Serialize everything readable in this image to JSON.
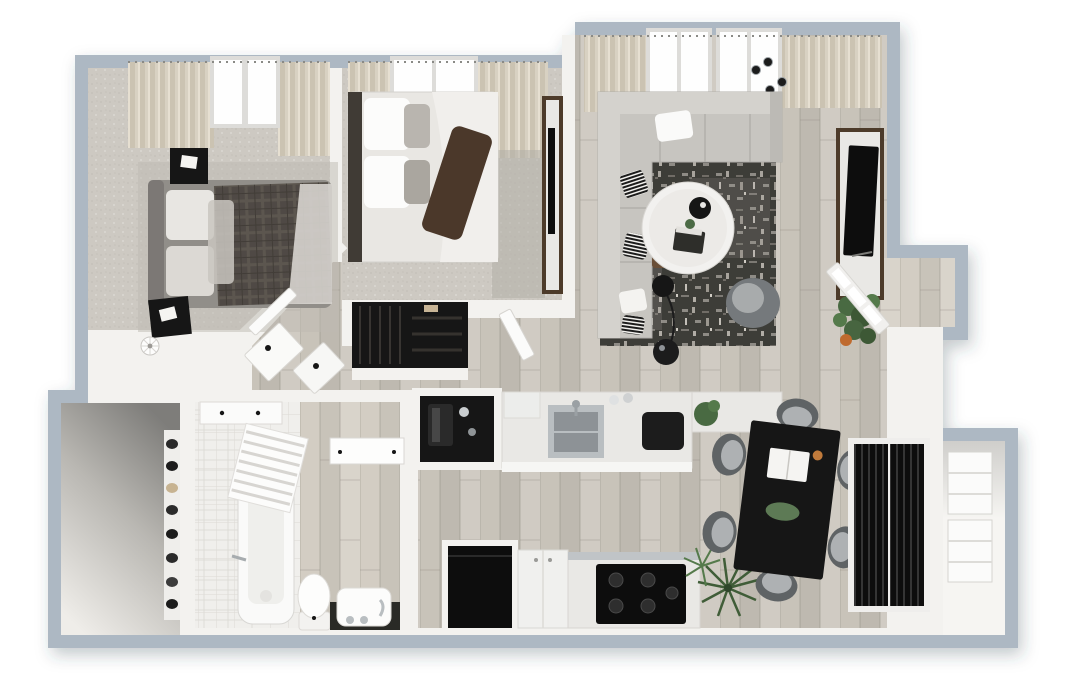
{
  "canvas": {
    "width": 1072,
    "height": 697,
    "background": "#ffffff"
  },
  "scene": {
    "type": "3d-floor-plan-render",
    "view": "top-down dollhouse",
    "rooms": [
      {
        "name": "bedroom-1",
        "items": [
          "upholstered-bed",
          "plaid-duvet",
          "nightstand",
          "nightstand",
          "area-rug",
          "floor-fan",
          "curtains",
          "window",
          "carpet-floor"
        ]
      },
      {
        "name": "bedroom-2",
        "items": [
          "bed-white-bedding",
          "brown-throw",
          "tv-console",
          "tv",
          "wardrobe-closet",
          "runner-rug",
          "curtains",
          "window",
          "door",
          "carpet-floor"
        ]
      },
      {
        "name": "living-room",
        "items": [
          "l-sectional-sofa",
          "striped-pillows",
          "patterned-area-rug",
          "round-marble-coffee-table",
          "swivel-accent-chair",
          "arc-floor-lamp",
          "walnut-side-table",
          "round-side-table",
          "media-console",
          "tv",
          "monstera-plant",
          "ceiling-spotlights",
          "curtains",
          "windows",
          "plank-floor"
        ]
      },
      {
        "name": "kitchen",
        "items": [
          "coffee-bar-nook",
          "coffee-machine",
          "peninsula-counter",
          "stainless-sink",
          "faucet",
          "toaster",
          "herb-plant",
          "microwave",
          "refrigerator-black",
          "base-cabinet-white",
          "range-cooktop",
          "palm-plant"
        ]
      },
      {
        "name": "dining-area",
        "items": [
          "black-dining-table",
          "dining-chair",
          "dining-chair",
          "dining-chair",
          "dining-chair",
          "dining-chair",
          "dining-chair",
          "open-magazine",
          "eucalyptus-centerpiece",
          "candle"
        ]
      },
      {
        "name": "bathroom",
        "items": [
          "bathtub",
          "shower-curtain",
          "subway-tile-walls",
          "tile-floor",
          "toilet",
          "vanity-sink",
          "faucet-set",
          "wall-cabinet",
          "mirror-panel"
        ]
      },
      {
        "name": "walk-in-closet",
        "items": [
          "shoe-shelf",
          "shoes"
        ]
      },
      {
        "name": "hallway",
        "items": [
          "dresser",
          "dresser",
          "angled-wall",
          "bedroom-door"
        ]
      },
      {
        "name": "entry",
        "items": [
          "glazed-front-door",
          "door-swing"
        ]
      },
      {
        "name": "storage-closet",
        "items": [
          "louvered-doors",
          "shelving-unit",
          "shelving-unit"
        ]
      }
    ],
    "dining_chair_count": 6,
    "palette": {
      "background": "#ffffff",
      "exterior_band": "#adb8c3",
      "wall": "#f3f2ef",
      "wood": "#c8c3b9",
      "wood_light": "#d3cdc3",
      "carpet": "#cdc9c2",
      "bath_tile": "#f0efec",
      "rug_dark": "#3d3c39",
      "sofa": "#c7c5c0",
      "sofa_back": "#d4d2cd",
      "marble": "#e9e8e5",
      "walnut": "#4e3b2b",
      "black_furniture": "#161616",
      "steel": "#b9bec1",
      "plant_green": "#4a6a42",
      "chair_gray": "#75797b",
      "duvet_plaid": "#4f4a44",
      "curtain": "#d8d1c2",
      "window_glow": "#fefefe",
      "walkin_shadow": "#7e7d7a"
    }
  }
}
